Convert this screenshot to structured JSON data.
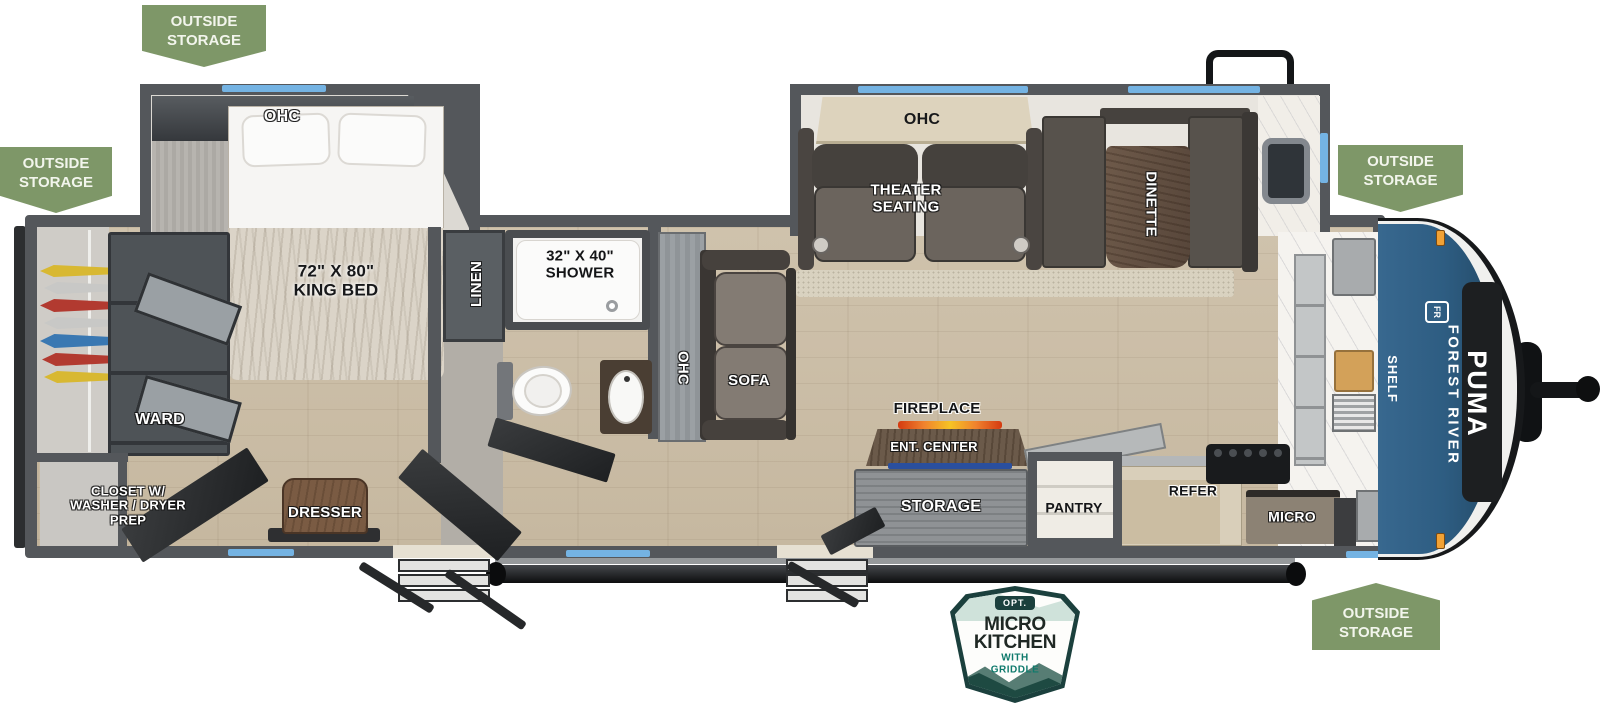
{
  "badge": {
    "outside_storage": "OUTSIDE\nSTORAGE"
  },
  "bedroom": {
    "ohc": "OHC",
    "king_bed": "72\" X 80\"\nKING BED",
    "ward": "WARD",
    "closet": "CLOSET W/\nWASHER / DRYER\nPREP",
    "dresser": "DRESSER"
  },
  "bath": {
    "linen": "LINEN",
    "shower": "32\" X 40\"\nSHOWER"
  },
  "living": {
    "sofa_ohc": "OHC",
    "sofa": "SOFA",
    "theater_ohc": "OHC",
    "theater_seating": "THEATER\nSEATING",
    "dinette": "DINETTE",
    "fireplace": "FIREPLACE",
    "ent_center": "ENT. CENTER",
    "storage": "STORAGE"
  },
  "kitchen": {
    "pantry": "PANTRY",
    "refer": "REFER",
    "micro": "MICRO",
    "shelf": "SHELF"
  },
  "brand": {
    "maker": "FOREST RIVER",
    "model": "PUMA",
    "logo": "FR"
  },
  "option_badge": {
    "tag": "OPT.",
    "title": "MICRO\nKITCHEN",
    "subtitle": "WITH\nGRIDDLE"
  },
  "colors": {
    "badge_green": "#7e9768",
    "accent_blue": "#74b3e3",
    "cap_blue": "#2e5d82",
    "flame_orange": "#f0822e",
    "teal": "#0f7a6c"
  }
}
